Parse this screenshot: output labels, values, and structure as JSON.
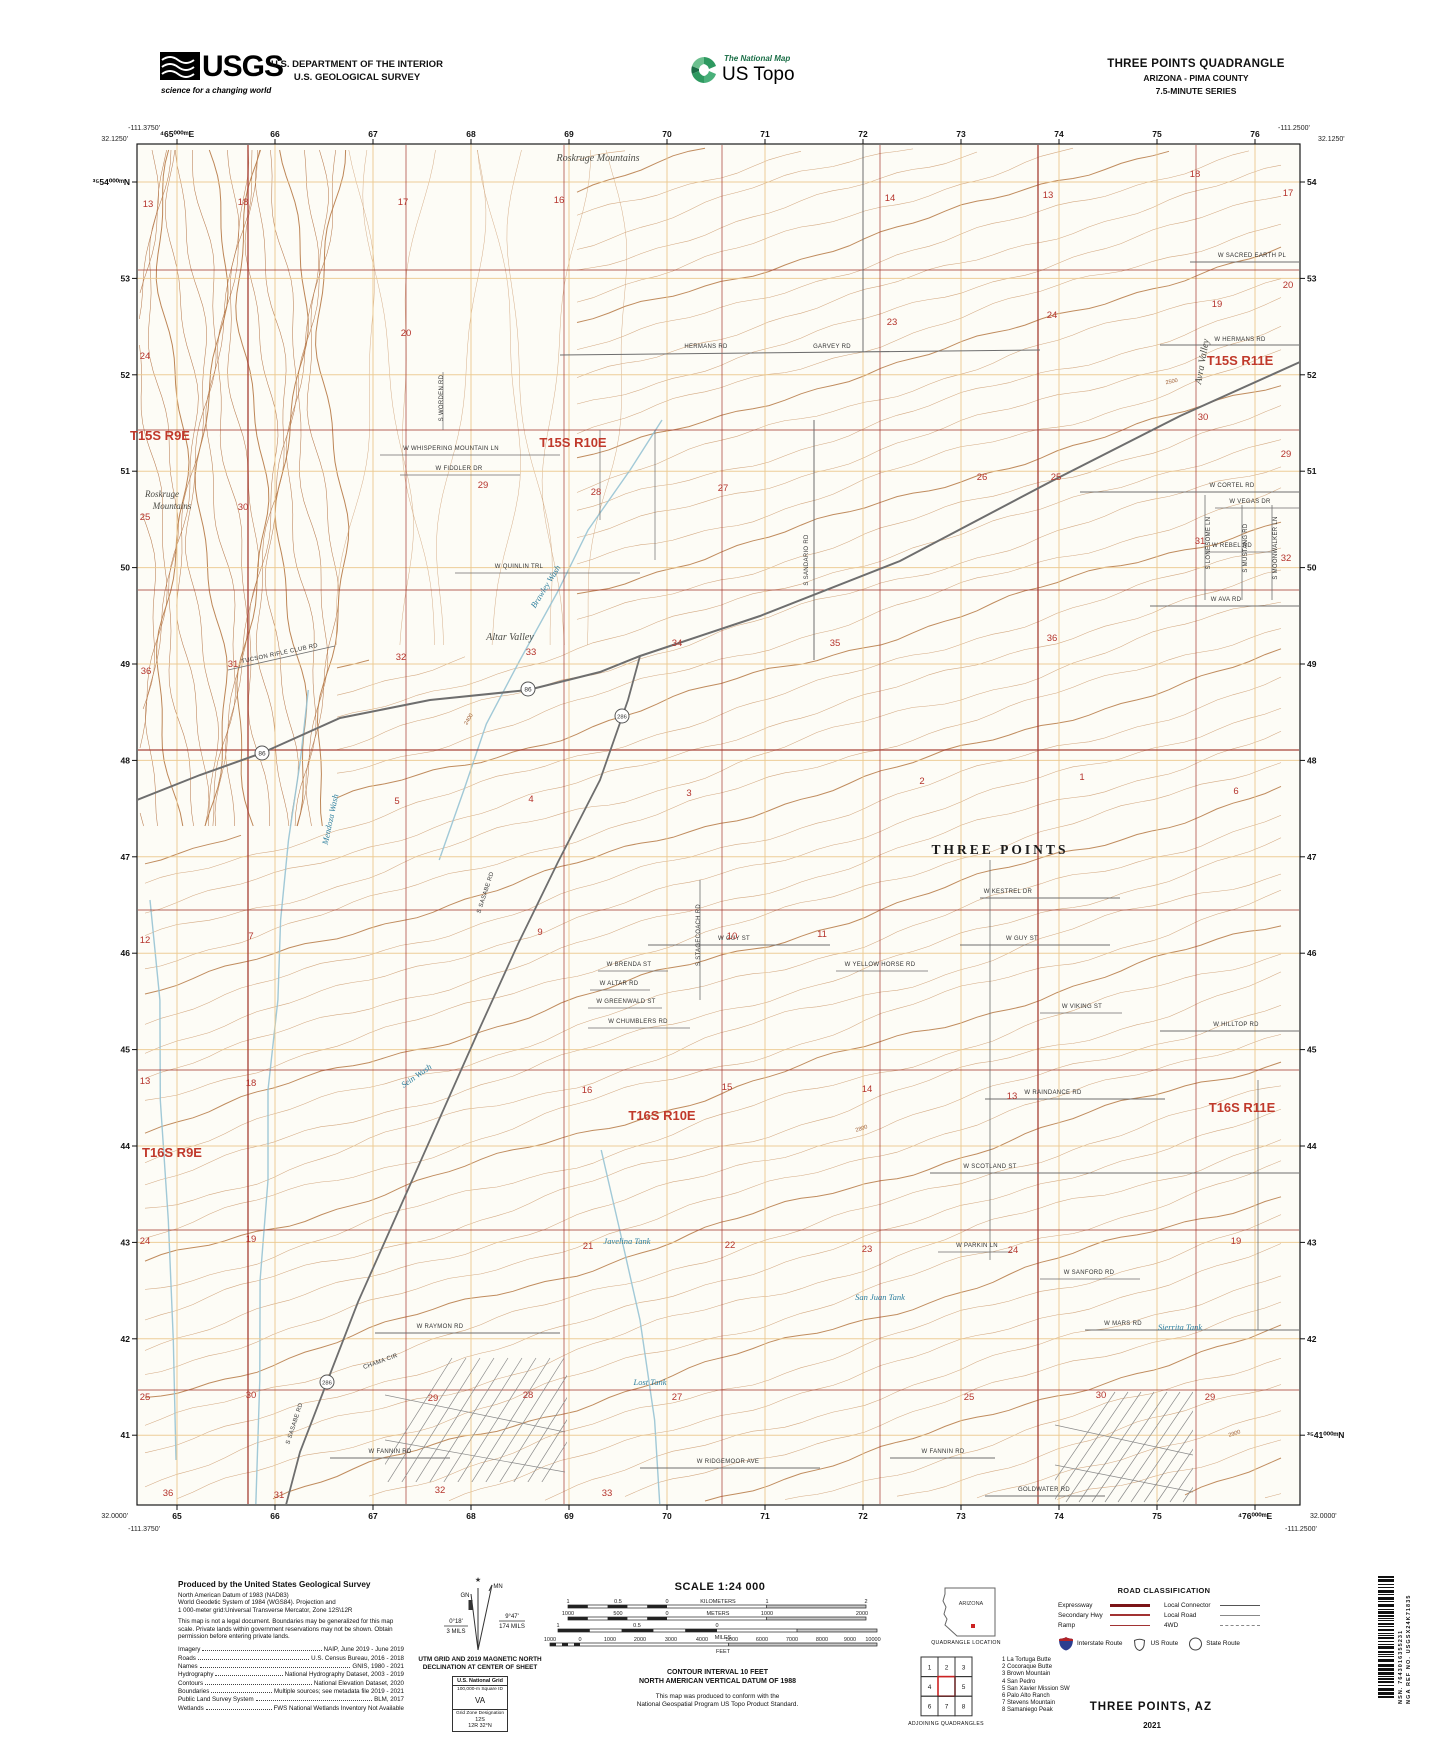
{
  "header": {
    "usgs": {
      "word": "USGS",
      "tagline": "science for a changing world"
    },
    "department_line1": "U.S. DEPARTMENT OF THE INTERIOR",
    "department_line2": "U.S. GEOLOGICAL SURVEY",
    "ustopo": {
      "brand": "The National Map",
      "product": "US Topo"
    },
    "title_block": {
      "line1": "THREE POINTS QUADRANGLE",
      "line2": "ARIZONA - PIMA COUNTY",
      "line3": "7.5-MINUTE SERIES"
    }
  },
  "map": {
    "rect": {
      "x": 137,
      "y": 144,
      "w": 1163,
      "h": 1361
    },
    "grid": {
      "e_start": 177,
      "e_step": 98,
      "e_count": 12,
      "n_start": 182,
      "n_step": 96.4,
      "n_count": 14
    },
    "colors": {
      "bg": "#fdfcf6",
      "contour": "#cfa177",
      "contour_index": "#b97f4e",
      "mountain": "#b5774a",
      "grid_orange": "#ecc98e",
      "section_red": "#a63d33",
      "label_red": "#c0392b",
      "number_red": "#b5342c",
      "water": "#2e7f9e",
      "wash": "#97c3d4",
      "road": "#6e6e6e",
      "neat": "#1a1a1a"
    },
    "corners": {
      "top_left_lon": "-111.3750'",
      "top_left_lat": "32.1250'",
      "top_right_lon": "-111.2500'",
      "top_right_lat": "32.1250'",
      "bottom_left_lat": "32.0000'",
      "bottom_left_lon": "-111.3750'",
      "bottom_right_lat": "32.0000'",
      "bottom_right_lon": "-111.2500'"
    },
    "top_labels": [
      "⁴65⁰⁰⁰ᵐE",
      "66",
      "67",
      "68",
      "69",
      "70",
      "71",
      "72",
      "73",
      "74",
      "75",
      "76"
    ],
    "bottom_labels": [
      "65",
      "66",
      "67",
      "68",
      "69",
      "70",
      "71",
      "72",
      "73",
      "74",
      "75",
      "⁴76⁰⁰⁰ᵐE"
    ],
    "left_labels": [
      "³⁵54⁰⁰⁰ᵐN",
      "53",
      "52",
      "51",
      "50",
      "49",
      "48",
      "47",
      "46",
      "45",
      "44",
      "43",
      "42",
      "41"
    ],
    "right_labels": [
      "54",
      "53",
      "52",
      "51",
      "50",
      "49",
      "48",
      "47",
      "46",
      "45",
      "44",
      "43",
      "42",
      "³⁵41⁰⁰⁰ᵐN"
    ],
    "township_labels": [
      {
        "t": "T15S R9E",
        "x": 160,
        "y": 440
      },
      {
        "t": "T15S R10E",
        "x": 573,
        "y": 447
      },
      {
        "t": "T15S R11E",
        "x": 1240,
        "y": 365
      },
      {
        "t": "T16S R9E",
        "x": 172,
        "y": 1157
      },
      {
        "t": "T16S R10E",
        "x": 662,
        "y": 1120
      },
      {
        "t": "T16S R11E",
        "x": 1242,
        "y": 1112
      }
    ],
    "place_labels": [
      {
        "t": "Roskruge Mountains",
        "x": 598,
        "y": 161,
        "s": 10
      },
      {
        "t": "Roskruge",
        "x": 162,
        "y": 497,
        "s": 9
      },
      {
        "t": "Mountains",
        "x": 172,
        "y": 509,
        "s": 9
      },
      {
        "t": "Altar Valley",
        "x": 510,
        "y": 640,
        "s": 10
      },
      {
        "t": "Avra Valley",
        "x": 1205,
        "y": 362,
        "s": 10,
        "r": -80
      },
      {
        "t": "THREE POINTS",
        "x": 1000,
        "y": 854,
        "s": 13,
        "big": true
      }
    ],
    "water_labels": [
      {
        "t": "Brawley Wash",
        "x": 548,
        "y": 588,
        "r": -58
      },
      {
        "t": "Mendoza Wash",
        "x": 333,
        "y": 820,
        "r": -78
      },
      {
        "t": "Sein Wash",
        "x": 418,
        "y": 1078,
        "r": -35
      },
      {
        "t": "Javelina Tank",
        "x": 627,
        "y": 1244,
        "r": 0
      },
      {
        "t": "San Juan Tank",
        "x": 880,
        "y": 1300,
        "r": 0
      },
      {
        "t": "Lost Tank",
        "x": 650,
        "y": 1385,
        "r": 0
      },
      {
        "t": "Sierrita Tank",
        "x": 1180,
        "y": 1330,
        "r": 0
      }
    ],
    "road_labels": [
      {
        "t": "W SACRED EARTH PL",
        "x": 1252,
        "y": 257,
        "r": 0
      },
      {
        "t": "W HERMANS RD",
        "x": 1240,
        "y": 341,
        "r": 0
      },
      {
        "t": "HERMANS RD",
        "x": 706,
        "y": 348,
        "r": 0
      },
      {
        "t": "GARVEY RD",
        "x": 832,
        "y": 348,
        "r": 0
      },
      {
        "t": "W CORTEL RD",
        "x": 1232,
        "y": 487,
        "r": 0
      },
      {
        "t": "W VEGAS DR",
        "x": 1250,
        "y": 503,
        "r": 0
      },
      {
        "t": "W REBEL RD",
        "x": 1232,
        "y": 547,
        "r": 0
      },
      {
        "t": "W AVA RD",
        "x": 1226,
        "y": 601,
        "r": 0
      },
      {
        "t": "S LONESOME LN",
        "x": 1210,
        "y": 543,
        "r": -90
      },
      {
        "t": "S MUSTANG RD",
        "x": 1247,
        "y": 548,
        "r": -90
      },
      {
        "t": "S MOONWALKER LN",
        "x": 1277,
        "y": 548,
        "r": -90
      },
      {
        "t": "W WHISPERING MOUNTAIN LN",
        "x": 451,
        "y": 450,
        "r": 0
      },
      {
        "t": "W FIDDLER DR",
        "x": 459,
        "y": 470,
        "r": 0
      },
      {
        "t": "W QUINLIN TRL",
        "x": 519,
        "y": 568,
        "r": 0
      },
      {
        "t": "S WORDEN RD",
        "x": 443,
        "y": 398,
        "r": -90
      },
      {
        "t": "TUCSON RIFLE CLUB RD",
        "x": 280,
        "y": 655,
        "r": -12
      },
      {
        "t": "W KESTREL DR",
        "x": 1008,
        "y": 893,
        "r": 0
      },
      {
        "t": "W GUY ST",
        "x": 734,
        "y": 940,
        "r": 0
      },
      {
        "t": "W GUY ST",
        "x": 1022,
        "y": 940,
        "r": 0
      },
      {
        "t": "W BRENDA ST",
        "x": 629,
        "y": 966,
        "r": 0
      },
      {
        "t": "W ALTAR RD",
        "x": 619,
        "y": 985,
        "r": 0
      },
      {
        "t": "W GREENWALD ST",
        "x": 626,
        "y": 1003,
        "r": 0
      },
      {
        "t": "W CHUMBLERS RD",
        "x": 638,
        "y": 1023,
        "r": 0
      },
      {
        "t": "W YELLOW HORSE RD",
        "x": 880,
        "y": 966,
        "r": 0
      },
      {
        "t": "W VIKING ST",
        "x": 1082,
        "y": 1008,
        "r": 0
      },
      {
        "t": "W HILLTOP RD",
        "x": 1236,
        "y": 1026,
        "r": 0
      },
      {
        "t": "W RAINDANCE RD",
        "x": 1053,
        "y": 1094,
        "r": 0
      },
      {
        "t": "W SCOTLAND ST",
        "x": 990,
        "y": 1168,
        "r": 0
      },
      {
        "t": "W PARKIN LN",
        "x": 977,
        "y": 1247,
        "r": 0
      },
      {
        "t": "W SANFORD RD",
        "x": 1089,
        "y": 1274,
        "r": 0
      },
      {
        "t": "W RAYMON RD",
        "x": 440,
        "y": 1328,
        "r": 0
      },
      {
        "t": "CHAMA CIR",
        "x": 381,
        "y": 1363,
        "r": -20
      },
      {
        "t": "W FANNIN RD",
        "x": 390,
        "y": 1453,
        "r": 0
      },
      {
        "t": "W FANNIN RD",
        "x": 943,
        "y": 1453,
        "r": 0
      },
      {
        "t": "W RIDGEMOOR AVE",
        "x": 728,
        "y": 1463,
        "r": 0
      },
      {
        "t": "GOLDWATER RD",
        "x": 1044,
        "y": 1491,
        "r": 0
      },
      {
        "t": "W MARS RD",
        "x": 1123,
        "y": 1325,
        "r": 0
      },
      {
        "t": "S SASABE RD",
        "x": 487,
        "y": 893,
        "r": -72
      },
      {
        "t": "S SASABE RD",
        "x": 296,
        "y": 1424,
        "r": -72
      },
      {
        "t": "S SANDARIO RD",
        "x": 808,
        "y": 560,
        "r": -90
      },
      {
        "t": "S STAGECOACH RD",
        "x": 700,
        "y": 935,
        "r": -90
      }
    ],
    "section_numbers": [
      {
        "n": "13",
        "x": 148,
        "y": 207
      },
      {
        "n": "18",
        "x": 243,
        "y": 205
      },
      {
        "n": "17",
        "x": 403,
        "y": 205
      },
      {
        "n": "16",
        "x": 559,
        "y": 203
      },
      {
        "n": "14",
        "x": 890,
        "y": 201
      },
      {
        "n": "13",
        "x": 1048,
        "y": 198
      },
      {
        "n": "18",
        "x": 1195,
        "y": 177
      },
      {
        "n": "17",
        "x": 1288,
        "y": 196
      },
      {
        "n": "24",
        "x": 145,
        "y": 359
      },
      {
        "n": "20",
        "x": 406,
        "y": 336
      },
      {
        "n": "23",
        "x": 892,
        "y": 325
      },
      {
        "n": "24",
        "x": 1052,
        "y": 318
      },
      {
        "n": "19",
        "x": 1217,
        "y": 307
      },
      {
        "n": "20",
        "x": 1288,
        "y": 288
      },
      {
        "n": "25",
        "x": 145,
        "y": 520
      },
      {
        "n": "30",
        "x": 243,
        "y": 510
      },
      {
        "n": "29",
        "x": 483,
        "y": 488
      },
      {
        "n": "28",
        "x": 596,
        "y": 495
      },
      {
        "n": "27",
        "x": 723,
        "y": 491
      },
      {
        "n": "26",
        "x": 982,
        "y": 480
      },
      {
        "n": "25",
        "x": 1056,
        "y": 480
      },
      {
        "n": "30",
        "x": 1203,
        "y": 420
      },
      {
        "n": "29",
        "x": 1286,
        "y": 457
      },
      {
        "n": "36",
        "x": 146,
        "y": 674
      },
      {
        "n": "31",
        "x": 233,
        "y": 667
      },
      {
        "n": "32",
        "x": 401,
        "y": 660
      },
      {
        "n": "33",
        "x": 531,
        "y": 655
      },
      {
        "n": "34",
        "x": 677,
        "y": 646
      },
      {
        "n": "35",
        "x": 835,
        "y": 646
      },
      {
        "n": "36",
        "x": 1052,
        "y": 641
      },
      {
        "n": "31",
        "x": 1200,
        "y": 544
      },
      {
        "n": "32",
        "x": 1286,
        "y": 561
      },
      {
        "n": "5",
        "x": 397,
        "y": 804
      },
      {
        "n": "4",
        "x": 531,
        "y": 802
      },
      {
        "n": "3",
        "x": 689,
        "y": 796
      },
      {
        "n": "2",
        "x": 922,
        "y": 784
      },
      {
        "n": "1",
        "x": 1082,
        "y": 780
      },
      {
        "n": "6",
        "x": 1236,
        "y": 794
      },
      {
        "n": "12",
        "x": 145,
        "y": 943
      },
      {
        "n": "7",
        "x": 251,
        "y": 939
      },
      {
        "n": "9",
        "x": 540,
        "y": 935
      },
      {
        "n": "10",
        "x": 732,
        "y": 939
      },
      {
        "n": "11",
        "x": 822,
        "y": 937
      },
      {
        "n": "13",
        "x": 145,
        "y": 1084
      },
      {
        "n": "18",
        "x": 251,
        "y": 1086
      },
      {
        "n": "16",
        "x": 587,
        "y": 1093
      },
      {
        "n": "15",
        "x": 727,
        "y": 1090
      },
      {
        "n": "14",
        "x": 867,
        "y": 1092
      },
      {
        "n": "13",
        "x": 1012,
        "y": 1099
      },
      {
        "n": "24",
        "x": 145,
        "y": 1244
      },
      {
        "n": "19",
        "x": 251,
        "y": 1242
      },
      {
        "n": "21",
        "x": 588,
        "y": 1249
      },
      {
        "n": "22",
        "x": 730,
        "y": 1248
      },
      {
        "n": "23",
        "x": 867,
        "y": 1252
      },
      {
        "n": "24",
        "x": 1013,
        "y": 1253
      },
      {
        "n": "19",
        "x": 1236,
        "y": 1244
      },
      {
        "n": "25",
        "x": 145,
        "y": 1400
      },
      {
        "n": "30",
        "x": 251,
        "y": 1398
      },
      {
        "n": "29",
        "x": 433,
        "y": 1401
      },
      {
        "n": "28",
        "x": 528,
        "y": 1398
      },
      {
        "n": "27",
        "x": 677,
        "y": 1400
      },
      {
        "n": "25",
        "x": 969,
        "y": 1400
      },
      {
        "n": "30",
        "x": 1101,
        "y": 1398
      },
      {
        "n": "29",
        "x": 1210,
        "y": 1400
      },
      {
        "n": "36",
        "x": 168,
        "y": 1496
      },
      {
        "n": "31",
        "x": 279,
        "y": 1498
      },
      {
        "n": "32",
        "x": 440,
        "y": 1493
      },
      {
        "n": "33",
        "x": 607,
        "y": 1496
      }
    ],
    "route_shields": [
      {
        "n": "86",
        "x": 528,
        "y": 689
      },
      {
        "n": "86",
        "x": 262,
        "y": 753
      },
      {
        "n": "286",
        "x": 622,
        "y": 716
      },
      {
        "n": "286",
        "x": 327,
        "y": 1382
      }
    ],
    "contour_elevations": [
      {
        "t": "2500",
        "x": 1172,
        "y": 383,
        "r": -12
      },
      {
        "t": "2800",
        "x": 862,
        "y": 1130,
        "r": -18
      },
      {
        "t": "2900",
        "x": 1235,
        "y": 1435,
        "r": -18
      },
      {
        "t": "2400",
        "x": 470,
        "y": 720,
        "r": -60
      }
    ]
  },
  "footer": {
    "credits": {
      "title": "Produced by the United States Geological Survey",
      "datum_lines": [
        "North American Datum of 1983 (NAD83)",
        "World Geodetic System of 1984 (WGS84).  Projection and",
        "1 000-meter grid:Universal Transverse Mercator, Zone 12S\\12R"
      ],
      "legal": "This map is not a legal document. Boundaries may be generalized for this map scale. Private lands within government reservations may not be shown. Obtain permission before entering private lands.",
      "sources": [
        [
          "Imagery",
          "NAIP, June 2019 - June 2019"
        ],
        [
          "Roads",
          "U.S. Census Bureau, 2016 - 2018"
        ],
        [
          "Names",
          "GNIS, 1980 - 2021"
        ],
        [
          "Hydrography",
          "National Hydrography Dataset, 2003 - 2019"
        ],
        [
          "Contours",
          "National Elevation Dataset, 2020"
        ],
        [
          "Boundaries",
          "Multiple sources; see metadata file 2019 - 2021"
        ],
        [
          "Public Land Survey System",
          "BLM, 2017"
        ],
        [
          "Wetlands",
          "FWS National Wetlands Inventory Not Available"
        ]
      ]
    },
    "declination": {
      "caption1": "UTM GRID AND 2019 MAGNETIC NORTH",
      "caption2": "DECLINATION AT CENTER OF SHEET",
      "gn": "GN",
      "mn": "MN",
      "gn_deg": "0°18'",
      "gn_mils": "3 MILS",
      "mn_deg": "9°47'",
      "mn_mils": "174 MILS",
      "star": "★"
    },
    "usng": {
      "title": "U.S. National Grid",
      "sq_label": "100,000-m Square ID",
      "square": "VA",
      "zone_label": "Grid Zone Designation",
      "zone_line": "12S",
      "zone_line2": "12R",
      "band": "32°N"
    },
    "scale": {
      "title": "SCALE 1:24 000",
      "bars": [
        {
          "unit": "KILOMETERS",
          "y": 10,
          "zero": 127,
          "from": 28,
          "to": 326,
          "labels": [
            [
              "1",
              28
            ],
            [
              "0.5",
              78
            ],
            [
              "0",
              127
            ],
            [
              "KILOMETERS",
              178
            ],
            [
              "1",
              227
            ],
            [
              "2",
              326
            ]
          ],
          "unit_below": ""
        },
        {
          "unit": "METERS",
          "y": 22,
          "zero": 127,
          "from": 28,
          "to": 326,
          "labels": [
            [
              "1000",
              28
            ],
            [
              "500",
              78
            ],
            [
              "0",
              127
            ],
            [
              "METERS",
              178
            ],
            [
              "1000",
              227
            ],
            [
              "2000",
              322
            ]
          ],
          "unit_below": ""
        },
        {
          "unit": "MILES",
          "y": 34,
          "zero": 177,
          "from": 18,
          "to": 337,
          "labels": [
            [
              "1",
              18
            ],
            [
              "0.5",
              97
            ],
            [
              "0",
              177
            ]
          ],
          "unit_below": "MILES"
        },
        {
          "unit": "FEET",
          "y": 48,
          "zero": 40,
          "from": 10,
          "to": 337,
          "labels": [
            [
              "1000",
              10
            ],
            [
              "0",
              40
            ],
            [
              "1000",
              70
            ],
            [
              "2000",
              100
            ],
            [
              "3000",
              131
            ],
            [
              "4000",
              162
            ],
            [
              "5000",
              192
            ],
            [
              "6000",
              222
            ],
            [
              "7000",
              252
            ],
            [
              "8000",
              282
            ],
            [
              "9000",
              310
            ],
            [
              "10000",
              333
            ]
          ],
          "unit_below": "FEET"
        }
      ],
      "note1": "CONTOUR INTERVAL 10 FEET",
      "note2": "NORTH AMERICAN VERTICAL DATUM OF 1988",
      "note3": "This map was produced to conform with the",
      "note4": "National Geospatial Program US Topo Product Standard."
    },
    "location": {
      "state": "ARIZONA",
      "caption": "QUADRANGLE LOCATION"
    },
    "adjoining": {
      "caption": "ADJOINING QUADRANGLES",
      "cells": [
        "1",
        "2",
        "3",
        "4",
        "5",
        "6",
        "7",
        "8"
      ],
      "list": [
        "1 La Tortuga Butte",
        "2 Cocoraque Butte",
        "3 Brown Mountain",
        "4 San Pedro",
        "5 San Xavier Mission SW",
        "6 Palo Alto Ranch",
        "7 Stevens Mountain",
        "8 Samaniego Peak"
      ]
    },
    "road_class": {
      "title": "ROAD CLASSIFICATION",
      "left": [
        {
          "label": "Expressway",
          "style": "expressway"
        },
        {
          "label": "Secondary Hwy",
          "style": "secondary"
        },
        {
          "label": "Ramp",
          "style": "ramp"
        }
      ],
      "right": [
        {
          "label": "Local Connector",
          "style": "connector"
        },
        {
          "label": "Local Road",
          "style": "local"
        },
        {
          "label": "4WD",
          "style": "fourwd"
        }
      ],
      "shields": [
        {
          "label": "Interstate Route",
          "type": "interstate"
        },
        {
          "label": "US Route",
          "type": "us"
        },
        {
          "label": "State Route",
          "type": "state"
        }
      ]
    },
    "map_name": "THREE POINTS,  AZ",
    "year": "2021",
    "nsn": "NSN. 7643016355231",
    "nga": "NGA REF NO. USGSX24K71835"
  }
}
